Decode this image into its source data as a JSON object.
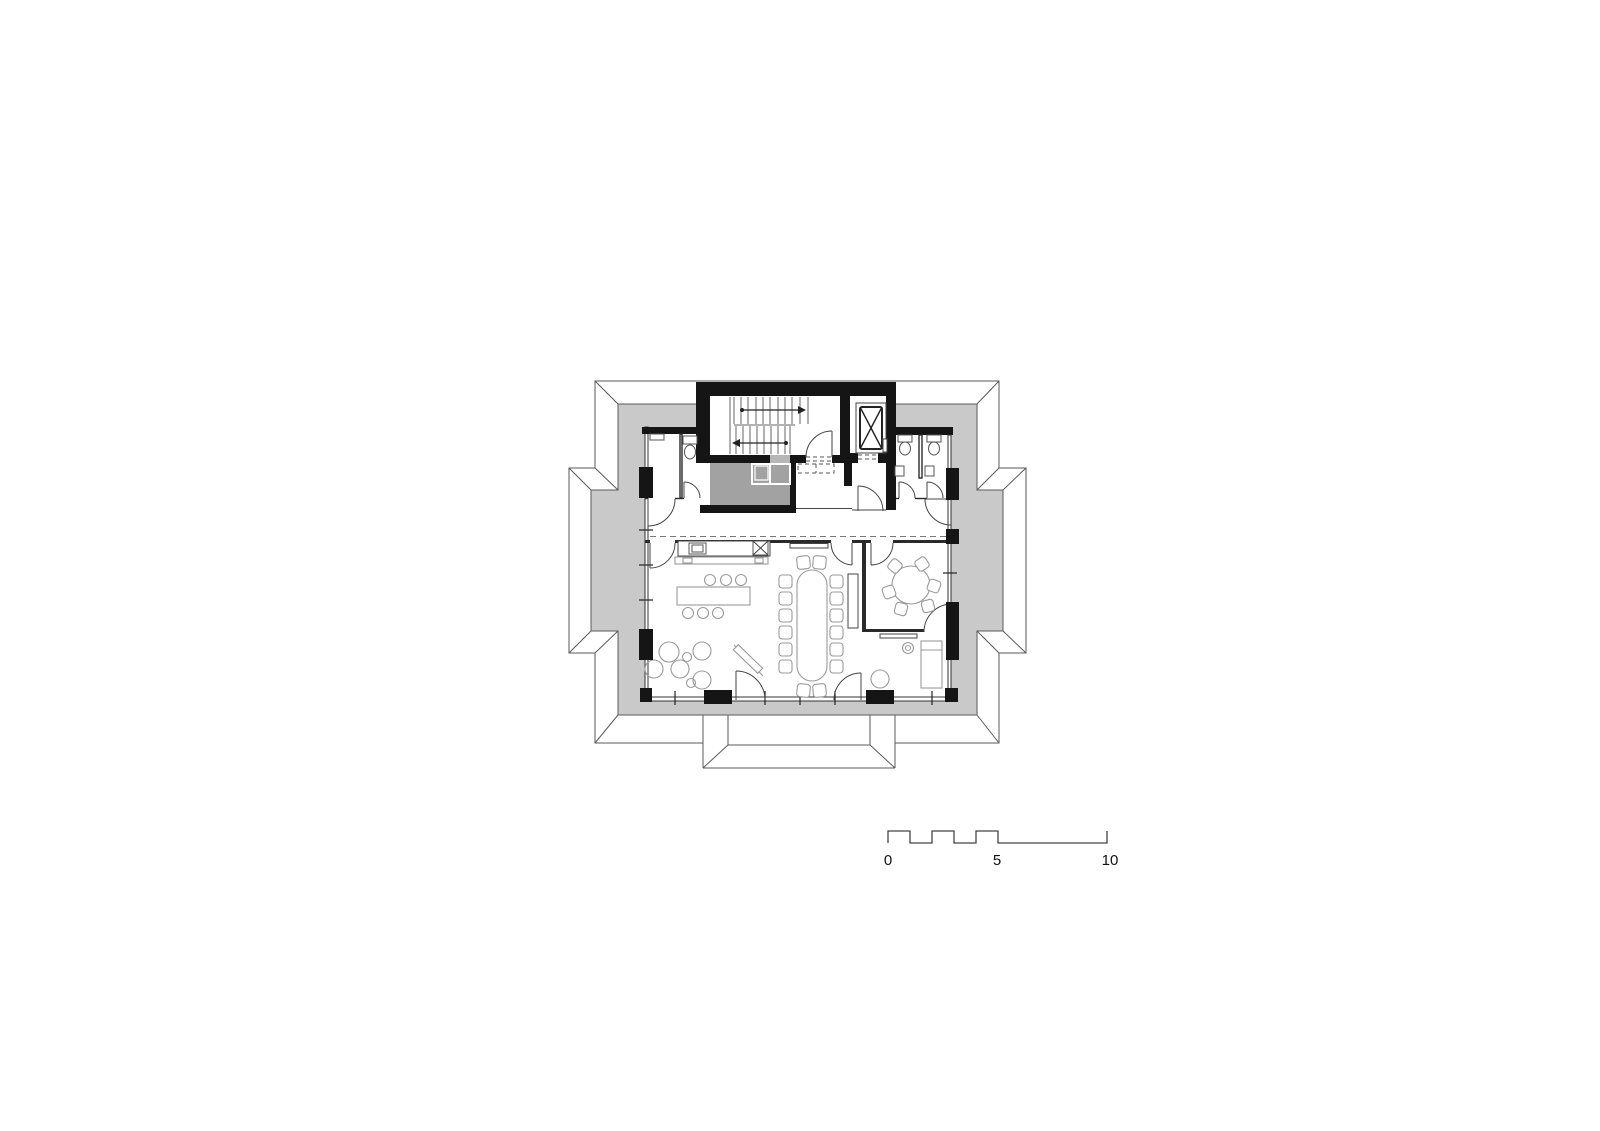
{
  "drawing": {
    "type": "architectural-floor-plan",
    "features": [
      "roof-outline",
      "stair-core",
      "staircase",
      "elevator",
      "wc-left",
      "wc-right",
      "storage-room",
      "pantry",
      "elevator-lobby",
      "corridor",
      "kitchenette-counter",
      "kitchen-island",
      "lounge-seating",
      "conference-table",
      "meeting-room",
      "round-table",
      "daybed",
      "window-piers",
      "scale-bar"
    ]
  },
  "colors": {
    "background": "#ffffff",
    "roof": "#c9c9c9",
    "wall": "#151515",
    "service_room": "#a2a2a2",
    "duct_block": "#b7b7b7",
    "outline": "#5a5a5a"
  },
  "scale_bar": {
    "labels": [
      "0",
      "5",
      "10"
    ]
  }
}
